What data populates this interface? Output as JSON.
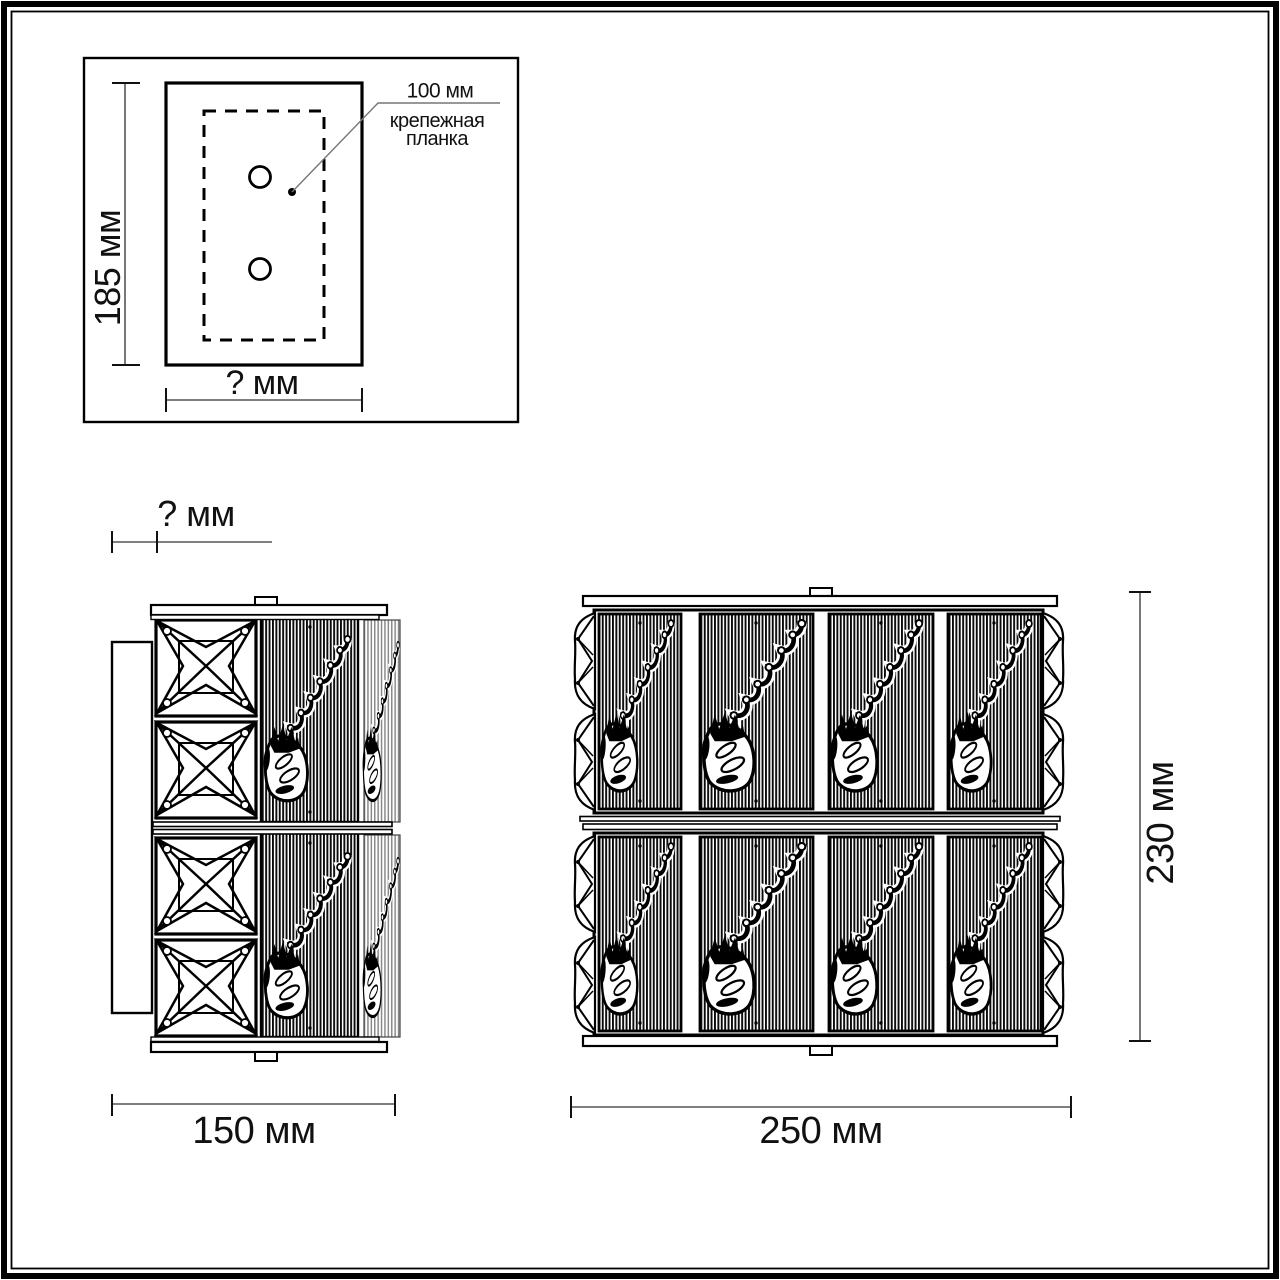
{
  "colors": {
    "ink": "#000000",
    "background": "#ffffff",
    "dim_line": "#555555"
  },
  "inset": {
    "height_label": "185 мм",
    "width_label": "? мм",
    "note": {
      "size": "100 мм",
      "line1": "крепежная",
      "line2": "планка"
    }
  },
  "side_view": {
    "depth_label": "? мм",
    "width_label": "150 мм"
  },
  "front_view": {
    "width_label": "250 мм",
    "height_label": "230 мм"
  }
}
